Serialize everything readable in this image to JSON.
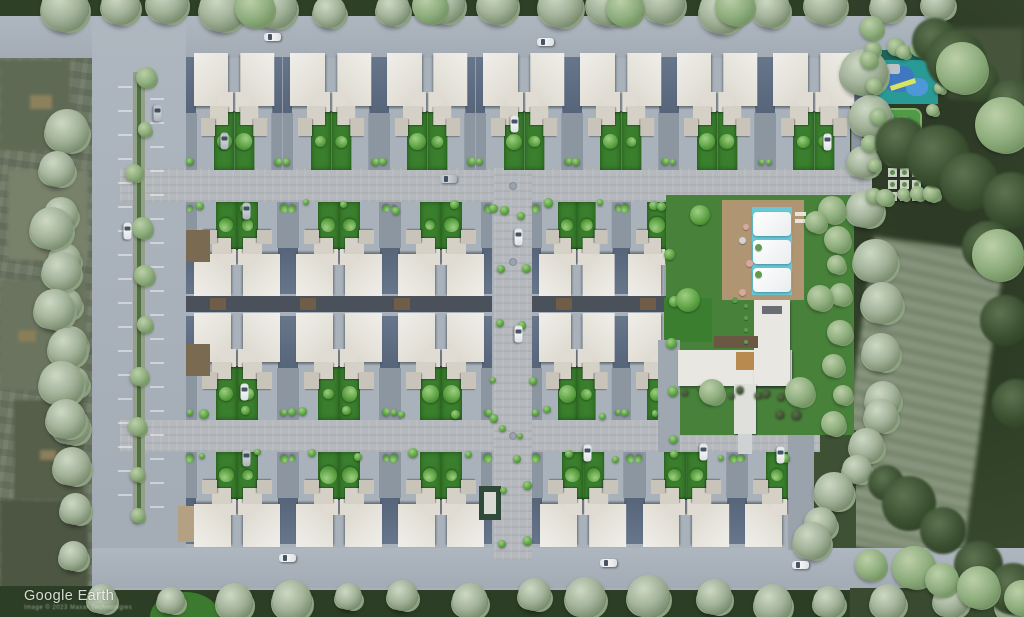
{
  "watermark": {
    "title": "Google Earth",
    "attribution": "Image © 2023 Maxar Technologies"
  },
  "palette": {
    "siteGround": "#a9b2ba",
    "road": "#a8b0b9",
    "paver": "#b5b9bd",
    "roofWhite": "#e7e5df",
    "terraceSlate": "#5c6a7d",
    "driveway": "#8c96a1",
    "gardenGreen": "#3a7f2d",
    "lawnGreen": "#48823a",
    "poolCyan": "#69c8d6",
    "deckTan": "#b09573",
    "coreBand": "#4a515b",
    "woodBrown": "#6f5d47",
    "playTeal": "#2a9a97",
    "playBlue": "#3f78c0",
    "bgFarmland": "#6d7864",
    "bgForest": "#394a30",
    "hedgeDark": "#2e4126"
  },
  "scene": {
    "base": [
      {
        "x": 0,
        "y": 0,
        "w": 1024,
        "h": 18,
        "c": "#2e4126"
      },
      {
        "x": 0,
        "y": 586,
        "w": 1024,
        "h": 31,
        "c": "#2c3e25"
      },
      {
        "x": 92,
        "y": 16,
        "w": 762,
        "h": 574,
        "c": "#a9b2ba"
      },
      {
        "x": 850,
        "y": 34,
        "w": 96,
        "h": 170,
        "c": "#a9b2ba"
      }
    ],
    "bgPatches": [
      {
        "x": 0,
        "y": 60,
        "w": 70,
        "h": 90,
        "c": "#5f6a54"
      },
      {
        "x": 8,
        "y": 170,
        "w": 80,
        "h": 90,
        "c": "#78816a"
      },
      {
        "x": 0,
        "y": 280,
        "w": 86,
        "h": 110,
        "c": "#6a745e"
      },
      {
        "x": 14,
        "y": 400,
        "w": 70,
        "h": 100,
        "c": "#555f4a"
      },
      {
        "x": 0,
        "y": 500,
        "w": 88,
        "h": 95,
        "c": "#4c5643"
      },
      {
        "x": 30,
        "y": 95,
        "w": 22,
        "h": 14,
        "c": "#8d815d"
      },
      {
        "x": 18,
        "y": 330,
        "w": 18,
        "h": 12,
        "c": "#897e58"
      },
      {
        "x": 40,
        "y": 450,
        "w": 16,
        "h": 10,
        "c": "#8d7f5b"
      }
    ],
    "rightBg": [
      {
        "x": 852,
        "y": 244,
        "w": 132,
        "h": 310,
        "cls": "building"
      },
      {
        "x": 948,
        "y": 28,
        "w": 76,
        "h": 70,
        "c": "#46543c",
        "cls": "blur3"
      },
      {
        "x": 810,
        "y": 430,
        "w": 46,
        "h": 120,
        "c": "#3e5134"
      }
    ],
    "roads": [
      {
        "x": 0,
        "y": 16,
        "w": 946,
        "h": 42,
        "cls": "road"
      },
      {
        "x": 92,
        "y": 16,
        "w": 94,
        "h": 556,
        "cls": "road"
      },
      {
        "x": 92,
        "y": 548,
        "w": 932,
        "h": 40,
        "cls": "road"
      },
      {
        "x": 120,
        "y": 168,
        "w": 752,
        "h": 34,
        "cls": "paver"
      },
      {
        "x": 120,
        "y": 420,
        "w": 700,
        "h": 32,
        "cls": "paver"
      },
      {
        "x": 494,
        "y": 168,
        "w": 38,
        "h": 392,
        "cls": "paver"
      },
      {
        "x": 788,
        "y": 430,
        "w": 26,
        "h": 120,
        "c": "#9aa3ac"
      },
      {
        "x": 664,
        "y": 200,
        "w": 14,
        "h": 224,
        "c": "#9aa3ac"
      }
    ],
    "median": {
      "base": {
        "x": 133,
        "y": 72,
        "w": 12,
        "h": 452,
        "c": "#95a08b"
      },
      "line": {
        "x": 137,
        "y": 74,
        "w": 4,
        "h": 448,
        "c": "#4f7040"
      },
      "ticks": {
        "xa": 118,
        "xb": 150,
        "y0": 86,
        "y1": 516,
        "step": 24,
        "w": 14
      }
    },
    "manholes": [
      [
        513,
        186
      ],
      [
        513,
        262
      ],
      [
        513,
        436
      ]
    ],
    "rows": [
      {
        "x": 186,
        "y": 52,
        "w": 676,
        "h": 118,
        "units": 14,
        "face": "down"
      },
      {
        "x": 186,
        "y": 202,
        "w": 306,
        "h": 96,
        "units": 6,
        "face": "up"
      },
      {
        "x": 532,
        "y": 202,
        "w": 134,
        "h": 96,
        "units": 3,
        "face": "up"
      },
      {
        "x": 186,
        "y": 312,
        "w": 306,
        "h": 108,
        "units": 6,
        "face": "down"
      },
      {
        "x": 532,
        "y": 312,
        "w": 134,
        "h": 108,
        "units": 3,
        "face": "down"
      },
      {
        "x": 186,
        "y": 452,
        "w": 306,
        "h": 96,
        "units": 6,
        "face": "up"
      },
      {
        "x": 532,
        "y": 452,
        "w": 256,
        "h": 96,
        "units": 5,
        "face": "up"
      }
    ],
    "coreBands": [
      {
        "x": 186,
        "y": 296,
        "w": 306,
        "h": 16
      },
      {
        "x": 532,
        "y": 296,
        "w": 134,
        "h": 16
      }
    ],
    "woodMarks": [
      [
        210,
        298
      ],
      [
        300,
        298
      ],
      [
        394,
        298
      ],
      [
        556,
        298
      ],
      [
        640,
        298
      ]
    ],
    "decks": [
      {
        "x": 186,
        "y": 230,
        "w": 24,
        "h": 32,
        "c": "#7a6a52"
      },
      {
        "x": 186,
        "y": 344,
        "w": 24,
        "h": 32,
        "c": "#7a6a52"
      },
      {
        "x": 178,
        "y": 506,
        "w": 16,
        "h": 36,
        "c": "#b4a184"
      }
    ],
    "utility": [
      {
        "x": 479,
        "y": 486,
        "w": 22,
        "h": 34,
        "c": "#2f4a38"
      },
      {
        "x": 484,
        "y": 492,
        "w": 12,
        "h": 22,
        "c": "#d8dad4"
      }
    ],
    "amenity": {
      "rects": [
        {
          "x": 666,
          "y": 195,
          "w": 188,
          "h": 240,
          "c": "#48823a"
        },
        {
          "x": 664,
          "y": 298,
          "w": 48,
          "h": 44,
          "c": "#3b7e30"
        },
        {
          "x": 658,
          "y": 340,
          "w": 22,
          "h": 112,
          "c": "#9fa8b0"
        },
        {
          "x": 722,
          "y": 200,
          "w": 82,
          "h": 100,
          "c": "#b09573"
        },
        {
          "x": 752,
          "y": 207,
          "w": 40,
          "h": 88,
          "c": "#69c8d6"
        },
        {
          "x": 678,
          "y": 350,
          "w": 114,
          "h": 36,
          "c": "#e9e7e1",
          "cls": "roof"
        },
        {
          "x": 754,
          "y": 300,
          "w": 36,
          "h": 86,
          "c": "#e9e7e1",
          "cls": "roof"
        },
        {
          "x": 762,
          "y": 306,
          "w": 20,
          "h": 8,
          "c": "#6a6e73"
        },
        {
          "x": 714,
          "y": 336,
          "w": 44,
          "h": 12,
          "c": "#6b5844"
        },
        {
          "x": 736,
          "y": 352,
          "w": 18,
          "h": 18,
          "c": "#b98a50"
        },
        {
          "x": 734,
          "y": 384,
          "w": 22,
          "h": 50,
          "c": "#dfe0dc",
          "cls": "roofbox"
        },
        {
          "x": 738,
          "y": 434,
          "w": 14,
          "h": 20,
          "c": "#cfd2d4"
        },
        {
          "x": 795,
          "y": 212,
          "w": 11,
          "h": 4,
          "c": "#e8e4da"
        },
        {
          "x": 795,
          "y": 219,
          "w": 11,
          "h": 4,
          "c": "#e8e4da"
        }
      ],
      "sails": [
        [
          753,
          212
        ],
        [
          753,
          240
        ],
        [
          753,
          268
        ]
      ],
      "circles": [
        [
          746,
          227,
          6,
          "#d8a8a0"
        ],
        [
          742,
          240,
          7,
          "#cfd3d6"
        ],
        [
          749,
          263,
          7,
          "#d8a8a0"
        ],
        [
          742,
          292,
          7,
          "#d8a8a0"
        ],
        [
          758,
          247,
          7,
          "#5f9c4e"
        ],
        [
          758,
          274,
          7,
          "#5f9c4e"
        ],
        [
          735,
          300,
          6,
          "#5f9c4e"
        ],
        [
          700,
          222,
          6,
          "#5f9c4e"
        ],
        [
          746,
          306,
          4,
          "#5f9c4e"
        ],
        [
          746,
          318,
          4,
          "#5f9c4e"
        ],
        [
          746,
          330,
          4,
          "#5f9c4e"
        ],
        [
          746,
          342,
          4,
          "#5f9c4e"
        ]
      ]
    },
    "playzone": {
      "rects": [
        {
          "x": 876,
          "y": 50,
          "w": 62,
          "h": 10,
          "c": "#20655a"
        },
        {
          "x": 876,
          "y": 60,
          "w": 62,
          "h": 44,
          "c": "#2a9a97"
        },
        {
          "x": 884,
          "y": 66,
          "w": 30,
          "h": 26,
          "c": "#3f78c0",
          "rr": "40%"
        },
        {
          "x": 906,
          "y": 78,
          "w": 22,
          "h": 18,
          "c": "#4f98d8",
          "rr": "45%"
        },
        {
          "x": 886,
          "y": 64,
          "w": 14,
          "h": 10,
          "c": "#bcc3c7",
          "rr": "20%"
        },
        {
          "x": 890,
          "y": 82,
          "w": 26,
          "h": 5,
          "c": "#d8e560",
          "rot": -18
        },
        {
          "x": 884,
          "y": 108,
          "w": 38,
          "h": 58,
          "c": "#4f9b48",
          "cls": "court"
        },
        {
          "x": 897,
          "y": 116,
          "w": 10,
          "h": 42,
          "c": "#6fb05c"
        }
      ],
      "grid": {
        "x": 888,
        "y": 168,
        "cols": 3,
        "rows": 3,
        "size": 9,
        "gap": 12,
        "c": "#ccd1c6",
        "dot": "#5f8c4e"
      }
    },
    "lawnCircle": {
      "x": 150,
      "y": 592,
      "w": 70,
      "h": 50,
      "c": "#3c7a2f"
    },
    "treeLines": [
      [
        60,
        6,
        940,
        8,
        17,
        15,
        24,
        "grey"
      ],
      [
        60,
        130,
        80,
        555,
        11,
        13,
        22,
        "grey"
      ],
      [
        52,
        230,
        70,
        420,
        6,
        16,
        24,
        "grey"
      ],
      [
        140,
        78,
        140,
        520,
        10,
        7,
        11,
        "med"
      ],
      [
        862,
        70,
        884,
        400,
        8,
        15,
        24,
        "grey"
      ],
      [
        884,
        420,
        812,
        545,
        6,
        14,
        20,
        "grey"
      ],
      [
        108,
        600,
        1008,
        599,
        16,
        13,
        22,
        "grey"
      ],
      [
        876,
        48,
        936,
        48,
        5,
        6,
        9,
        "med"
      ],
      [
        874,
        62,
        874,
        192,
        6,
        6,
        9,
        "med"
      ],
      [
        937,
        62,
        937,
        192,
        6,
        6,
        9,
        "med"
      ],
      [
        880,
        196,
        934,
        196,
        4,
        6,
        9,
        "med"
      ],
      [
        200,
        206,
        650,
        206,
        10,
        3,
        5,
        "bright"
      ],
      [
        200,
        414,
        650,
        414,
        10,
        3,
        5,
        "bright"
      ],
      [
        200,
        456,
        780,
        456,
        12,
        3,
        5,
        "bright"
      ],
      [
        500,
        215,
        500,
        540,
        7,
        3,
        5,
        "bright"
      ],
      [
        527,
        215,
        527,
        540,
        7,
        3,
        5,
        "bright"
      ],
      [
        830,
        205,
        838,
        425,
        8,
        9,
        14,
        "med"
      ],
      [
        668,
        210,
        668,
        440,
        6,
        4,
        6,
        "bright"
      ],
      [
        930,
        40,
        1010,
        100,
        4,
        20,
        30,
        "dark"
      ],
      [
        900,
        140,
        1010,
        200,
        4,
        22,
        32,
        "dark"
      ],
      [
        880,
        480,
        1020,
        590,
        5,
        18,
        28,
        "dark"
      ],
      [
        990,
        250,
        1015,
        400,
        3,
        20,
        28,
        "dark"
      ],
      [
        686,
        392,
        752,
        392,
        6,
        3,
        5,
        "dark"
      ],
      [
        768,
        390,
        790,
        420,
        4,
        4,
        6,
        "dark"
      ],
      [
        870,
        560,
        1020,
        600,
        5,
        14,
        22,
        "med"
      ]
    ],
    "treeSpots": [
      [
        700,
        215,
        10,
        "bright"
      ],
      [
        688,
        300,
        12,
        "bright"
      ],
      [
        712,
        392,
        13,
        "med"
      ],
      [
        800,
        392,
        15,
        "med"
      ],
      [
        820,
        298,
        13,
        "med"
      ],
      [
        816,
        222,
        11,
        "med"
      ],
      [
        962,
        68,
        26,
        "med"
      ],
      [
        1003,
        125,
        28,
        "med"
      ],
      [
        998,
        255,
        26,
        "med"
      ],
      [
        872,
        28,
        12,
        "med"
      ],
      [
        255,
        8,
        20,
        "med"
      ],
      [
        430,
        6,
        18,
        "med"
      ],
      [
        625,
        8,
        19,
        "med"
      ],
      [
        735,
        6,
        20,
        "med"
      ]
    ],
    "cars": [
      [
        272,
        37,
        "h",
        "w"
      ],
      [
        545,
        42,
        "h",
        "w"
      ],
      [
        224,
        141,
        "v",
        "s"
      ],
      [
        514,
        124,
        "v",
        "w"
      ],
      [
        827,
        142,
        "v",
        "w"
      ],
      [
        157,
        113,
        "v",
        "s"
      ],
      [
        127,
        231,
        "v",
        "w"
      ],
      [
        246,
        211,
        "v",
        "s"
      ],
      [
        448,
        179,
        "h",
        "s"
      ],
      [
        518,
        237,
        "v",
        "w"
      ],
      [
        518,
        334,
        "v",
        "w"
      ],
      [
        244,
        392,
        "v",
        "w"
      ],
      [
        246,
        458,
        "v",
        "s"
      ],
      [
        587,
        453,
        "v",
        "w"
      ],
      [
        703,
        452,
        "v",
        "w"
      ],
      [
        780,
        455,
        "v",
        "w"
      ],
      [
        287,
        558,
        "h",
        "w"
      ],
      [
        608,
        563,
        "h",
        "w"
      ],
      [
        800,
        565,
        "h",
        "w"
      ]
    ]
  }
}
